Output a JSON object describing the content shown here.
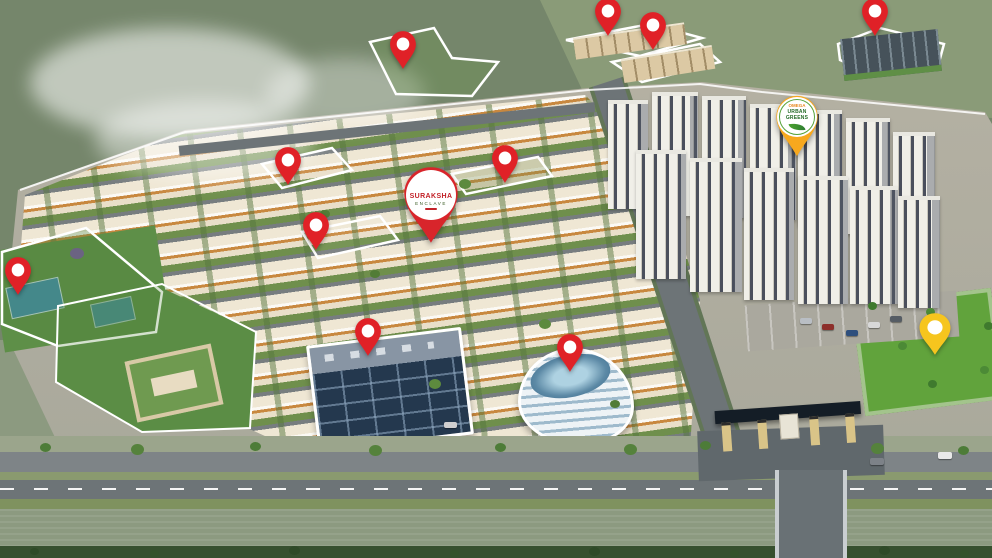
{
  "palette": {
    "pin_red": "#e02127",
    "pin_yellow": "#f6c51e",
    "pin_orange": "#f7a81e",
    "canal": "#35749c",
    "road": "#6d7477",
    "lawn": "#61a33c",
    "park": "#5e8f48",
    "villa_cream": "#efe6d3",
    "villa_orange": "#c8873f",
    "tower_dark": "#474c59",
    "glass_building": "#2d4056",
    "outline_white": "#ffffff"
  },
  "badges": {
    "suraksha": {
      "name": "SURAKSHA",
      "subtitle": "ENCLAVE",
      "name_color": "#c22127",
      "pin_color": "#d8252b"
    },
    "omega": {
      "brand": "OMEGA",
      "name": "URBAN GREENS",
      "brand_color": "#e8871e",
      "name_color": "#256b28",
      "pin_color": "#f7a81e"
    }
  },
  "markers": {
    "pins": [
      {
        "name": "pin-park-northwest",
        "x": 403,
        "y": 70,
        "w": 30,
        "h": 40,
        "color": "#e02127"
      },
      {
        "name": "pin-apartments-north-1",
        "x": 608,
        "y": 37,
        "w": 30,
        "h": 40,
        "color": "#e02127"
      },
      {
        "name": "pin-apartments-north-2",
        "x": 653,
        "y": 51,
        "w": 30,
        "h": 40,
        "color": "#e02127"
      },
      {
        "name": "pin-school-northeast",
        "x": 875,
        "y": 37,
        "w": 30,
        "h": 40,
        "color": "#e02127"
      },
      {
        "name": "pin-villa-plot-1",
        "x": 288,
        "y": 186,
        "w": 30,
        "h": 40,
        "color": "#e02127"
      },
      {
        "name": "pin-villa-plot-2",
        "x": 316,
        "y": 251,
        "w": 30,
        "h": 40,
        "color": "#e02127"
      },
      {
        "name": "pin-amenity-strip",
        "x": 505,
        "y": 184,
        "w": 30,
        "h": 40,
        "color": "#e02127"
      },
      {
        "name": "pin-sports-park-west",
        "x": 18,
        "y": 296,
        "w": 30,
        "h": 40,
        "color": "#e02127"
      },
      {
        "name": "pin-commercial-building",
        "x": 368,
        "y": 357,
        "w": 30,
        "h": 40,
        "color": "#e02127"
      },
      {
        "name": "pin-clubhouse",
        "x": 570,
        "y": 373,
        "w": 30,
        "h": 40,
        "color": "#e02127"
      },
      {
        "name": "pin-lawn-southeast",
        "x": 935,
        "y": 356,
        "w": 36,
        "h": 44,
        "color": "#f6c51e"
      }
    ]
  }
}
